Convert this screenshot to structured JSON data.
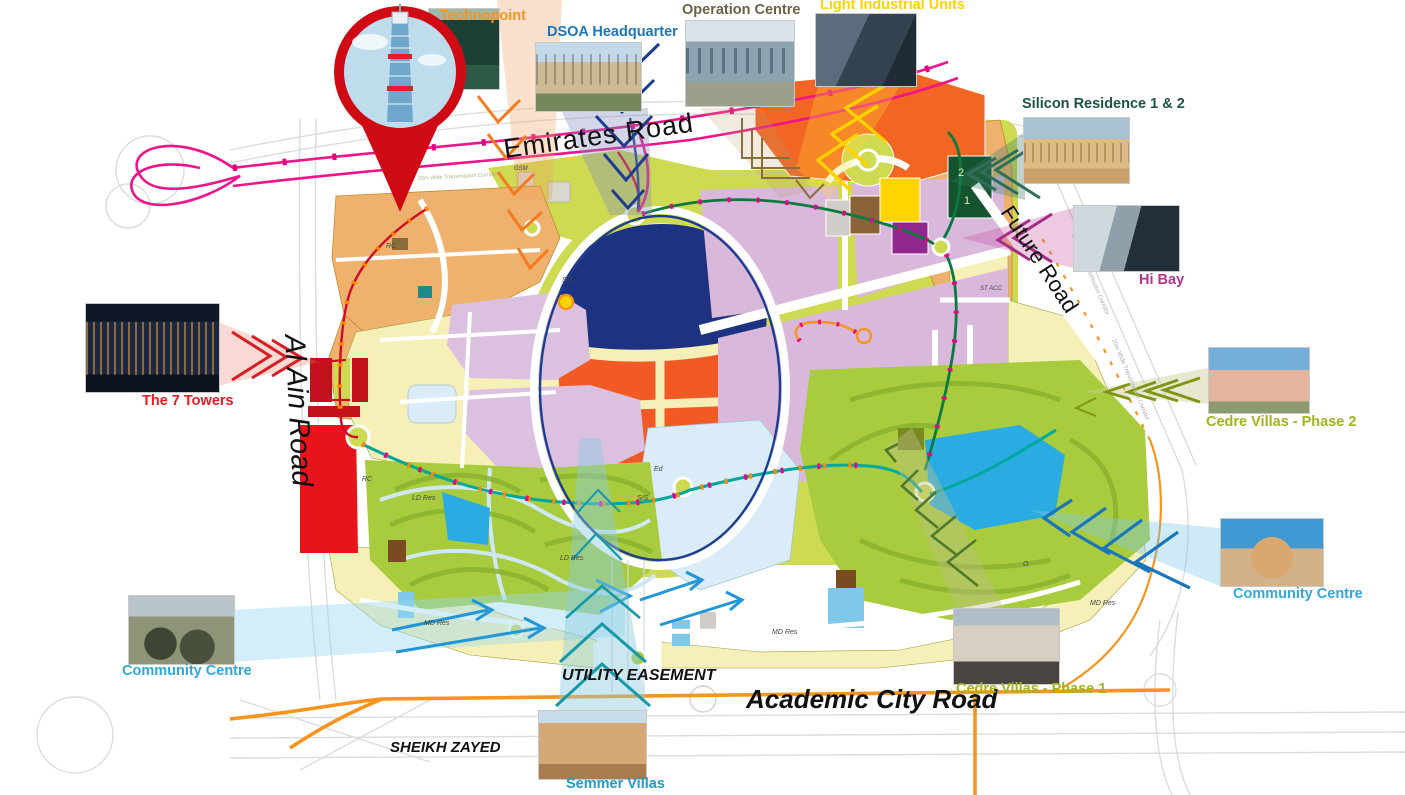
{
  "roads": {
    "emirates": "Emirates Road",
    "al_ain": "Al Ain Road",
    "future": "Future Road",
    "academic_city": "Academic City Road",
    "utility_easement": "UTILITY EASEMENT",
    "sheikh_zayed": "SHEIKH ZAYED",
    "transmission_corridor": "20m Wide Transmission Corridor"
  },
  "landmarks": [
    {
      "id": "technopoint",
      "label": "Technopoint",
      "color": "#f7941d"
    },
    {
      "id": "dsoa-headquarter",
      "label": "DSOA Headquarter",
      "color": "#1c75bc"
    },
    {
      "id": "operation-centre",
      "label": "Operation Centre",
      "color": "#6d6245"
    },
    {
      "id": "light-industrial",
      "label": "Light Industrial Units",
      "color": "#ffd200"
    },
    {
      "id": "silicon-residence",
      "label": "Silicon Residence 1 & 2",
      "color": "#1b563b"
    },
    {
      "id": "hi-bay",
      "label": "Hi Bay",
      "color": "#b5338a"
    },
    {
      "id": "the-7-towers",
      "label": "The 7 Towers",
      "color": "#e31b23"
    },
    {
      "id": "cedre-villas-2",
      "label": "Cedre Villas - Phase 2",
      "color": "#a0b41e"
    },
    {
      "id": "community-centre-e",
      "label": "Community Centre",
      "color": "#2fa8df"
    },
    {
      "id": "community-centre-w",
      "label": "Community Centre",
      "color": "#2fa8df"
    },
    {
      "id": "cedre-villas-1",
      "label": "Cedre Villas - Phase 1",
      "color": "#a0b41e"
    },
    {
      "id": "semmer-villas",
      "label": "Semmer Villas",
      "color": "#1e9cc8"
    }
  ],
  "map_labels": [
    {
      "t": "LD Res"
    },
    {
      "t": "LD Res"
    },
    {
      "t": "MD Res"
    },
    {
      "t": "MD Res"
    },
    {
      "t": "MD Res"
    },
    {
      "t": "RC"
    },
    {
      "t": "RC"
    },
    {
      "t": "Ed"
    },
    {
      "t": "S/S"
    },
    {
      "t": "O"
    },
    {
      "t": "2"
    },
    {
      "t": "1"
    },
    {
      "t": "ST ACC"
    },
    {
      "t": "GSM"
    },
    {
      "t": "S/S"
    }
  ],
  "colors": {
    "emirates_road_pink": "#ef148b",
    "academic_road_orange": "#f7941d",
    "teal_route": "#00a79d",
    "green_route": "#0b7a3e",
    "blue_route": "#1d3d8f",
    "red_route": "#d20a2a",
    "parcel_tan": "#efb26e",
    "parcel_cream": "#f6f0b8",
    "parcel_olive": "#cdda52",
    "parcel_purple": "#d9b8dc",
    "parcel_orange": "#f26522",
    "parcel_navy": "#1e3282",
    "parcel_red": "#e8141c",
    "villa_green": "#a8cc3e",
    "lake_blue": "#2aace2",
    "pin_red": "#cf0a14"
  }
}
